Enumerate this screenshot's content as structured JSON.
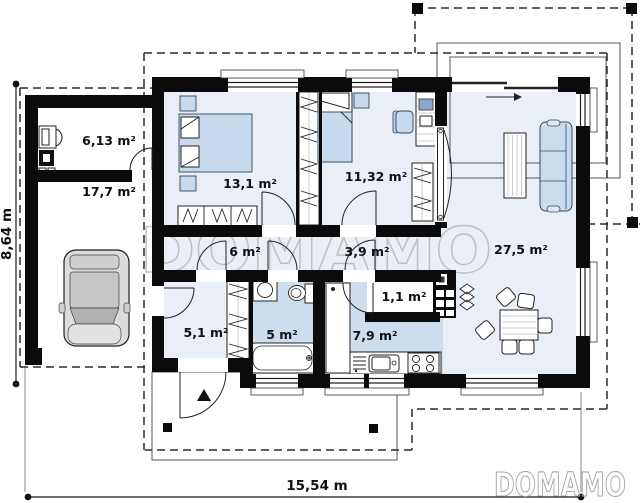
{
  "plan_title": "Single-storey house floor plan",
  "watermark": {
    "center": "DOMAMO",
    "corner": "DOMAMO"
  },
  "dimensions": {
    "total_width": "15,54 m",
    "total_height": "8,64 m"
  },
  "rooms": {
    "boiler_room": {
      "area": "6,13 m²"
    },
    "garage": {
      "area": "17,7 m²"
    },
    "bedroom": {
      "area": "13,1 m²"
    },
    "bedroom_2": {
      "area": "11,32 m²"
    },
    "living_room": {
      "area": "27,5 m²"
    },
    "hall": {
      "area": "6 m²"
    },
    "corridor": {
      "area": "3,9 m²"
    },
    "vestibule": {
      "area": "5,1 m²"
    },
    "bathroom": {
      "area": "5 m²"
    },
    "kitchen": {
      "area": "7,9 m²"
    },
    "pantry": {
      "area": "1,1 m²"
    }
  },
  "colors": {
    "wall": "#0b0b0b",
    "floor_light": "#e9eef7",
    "floor_mid": "#ccdcee",
    "furniture_blue": "#c7d9ec",
    "watermark_gray": "#bfbfbf",
    "car_body": "#dcdcdc"
  }
}
